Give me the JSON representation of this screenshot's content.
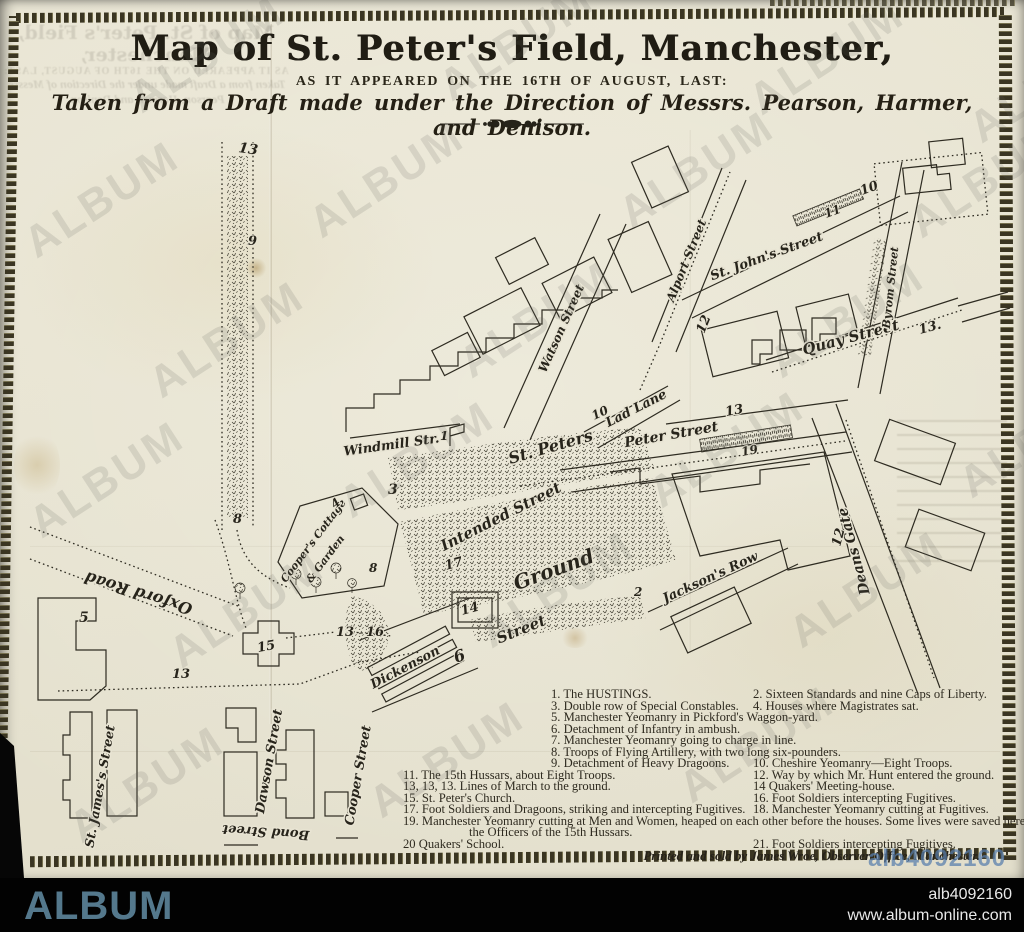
{
  "header": {
    "title": "Map of St. Peter's Field, Manchester,",
    "subtitle": "AS IT APPEARED ON THE 16TH OF AUGUST, LAST:",
    "tagline": "Taken from a Draft made under the Direction of Messrs. Pearson, Harmer, and Denison."
  },
  "map": {
    "street_labels": [
      "Windmill Str.",
      "St. Peters",
      "Intended Street",
      "Ground",
      "Street",
      "Peter Street",
      "Lad Lane",
      "Quay Street",
      "St. John's Street",
      "Byrom Street",
      "Alport Street",
      "Watson Street",
      "Deans Gate",
      "Jackson's Row",
      "Oxford Road",
      "Cooper's Cottage",
      "& Garden",
      "Dickenson",
      "Cooper Street",
      "Bond Street",
      "Dawson Street",
      "St. James's Street"
    ],
    "numbers": [
      "13",
      "9",
      "8",
      "5",
      "15",
      "13",
      "16",
      "13",
      "3",
      "4",
      "8",
      "1",
      "17",
      "14",
      "6",
      "2",
      "19",
      "11",
      "10",
      "13",
      "13.",
      "12",
      "12",
      "10"
    ]
  },
  "legend": {
    "rows": [
      {
        "left": "1.  The HUSTINGS.",
        "right": "2.  Sixteen Standards and nine Caps of Liberty."
      },
      {
        "left": "3.  Double row of Special Constables.",
        "right": "4.  Houses where Magistrates sat."
      },
      {
        "left": "5.  Manchester Yeomanry in Pickford's Waggon-yard.",
        "right": ""
      },
      {
        "left": "6.  Detachment of Infantry in ambush.",
        "right": ""
      },
      {
        "left": "7.  Manchester Yeomanry going to charge in line.",
        "right": ""
      },
      {
        "left": "8.  Troops of Flying Artillery, with two long six-pounders.",
        "right": ""
      },
      {
        "left": "9.  Detachment of Heavy Dragoons.",
        "right": "10.  Cheshire Yeomanry—Eight Troops."
      },
      {
        "left": "11.  The 15th Hussars, about Eight Troops.",
        "right": "12.  Way by which Mr. Hunt entered the ground."
      },
      {
        "left": "13, 13, 13.  Lines of March to the ground.",
        "right": "14  Quakers' Meeting-house."
      },
      {
        "left": "15.  St. Peter's Church.",
        "right": "16.  Foot Soldiers intercepting Fugitives."
      },
      {
        "left": "17.  Foot Soldiers and Dragoons, striking and intercepting Fugitives.",
        "right": "18.  Manchester Yeomanry cutting at Fugitives."
      }
    ],
    "row19_line1": "19.  Manchester Yeomanry cutting at Men and Women, heaped on each other before the houses.   Some lives were saved here by",
    "row19_line2": "the Officers of the 15th Hussars.",
    "row20": {
      "left": "20  Quakers' School.",
      "right": "21.  Foot Soldiers intercepting Fugitives."
    },
    "imprint": "Printed and sold by James Wroe, Observer-Office, Manchester."
  },
  "watermark": {
    "text": "ALBUM"
  },
  "footer": {
    "brand": "ALBUM",
    "image_id": "alb4092160",
    "website": "www.album-online.com",
    "brand_color": "#54788c"
  }
}
